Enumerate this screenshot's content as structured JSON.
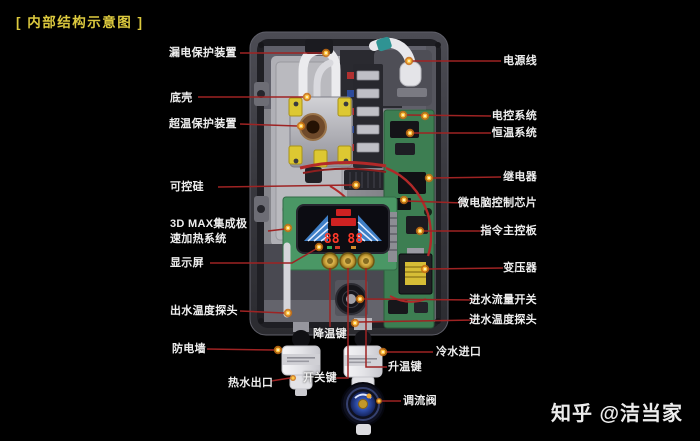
{
  "title": "[ 内部结构示意图 ]",
  "watermark": "知乎 @洁当家",
  "device": {
    "description": "即热式电热水器内部结构图",
    "display_value": "88 88"
  },
  "colors": {
    "background": "#000000",
    "title_yellow": "#dcc93e",
    "label_white": "#eeeeee",
    "leader_line_red": "#9e2323",
    "dot_orange": "#ffc845",
    "pcb_green": "#3d7e52",
    "display_digit_red": "#ff3a2a",
    "valve_blue": "#2c4aa4",
    "case_gray": "#38383e"
  },
  "labels": {
    "left": [
      {
        "text": "漏电保护装置"
      },
      {
        "text": "底壳"
      },
      {
        "text": "超温保护装置"
      },
      {
        "text": "可控硅"
      },
      {
        "line1": "3D MAX集成极",
        "line2": "速加热系统"
      },
      {
        "text": "显示屏"
      },
      {
        "text": "出水温度探头"
      },
      {
        "text": "防电墙"
      },
      {
        "text": "热水出口"
      }
    ],
    "bottom": [
      {
        "text": "降温键"
      },
      {
        "text": "开关键"
      },
      {
        "text": "升温键"
      },
      {
        "text": "调流阀"
      }
    ],
    "right": [
      {
        "text": "电源线"
      },
      {
        "text": "电控系统"
      },
      {
        "text": "恒温系统"
      },
      {
        "text": "继电器"
      },
      {
        "text": "微电脑控制芯片"
      },
      {
        "text": "指令主控板"
      },
      {
        "text": "变压器"
      },
      {
        "text": "进水流量开关"
      },
      {
        "text": "进水温度探头"
      },
      {
        "text": "冷水进口"
      }
    ]
  }
}
